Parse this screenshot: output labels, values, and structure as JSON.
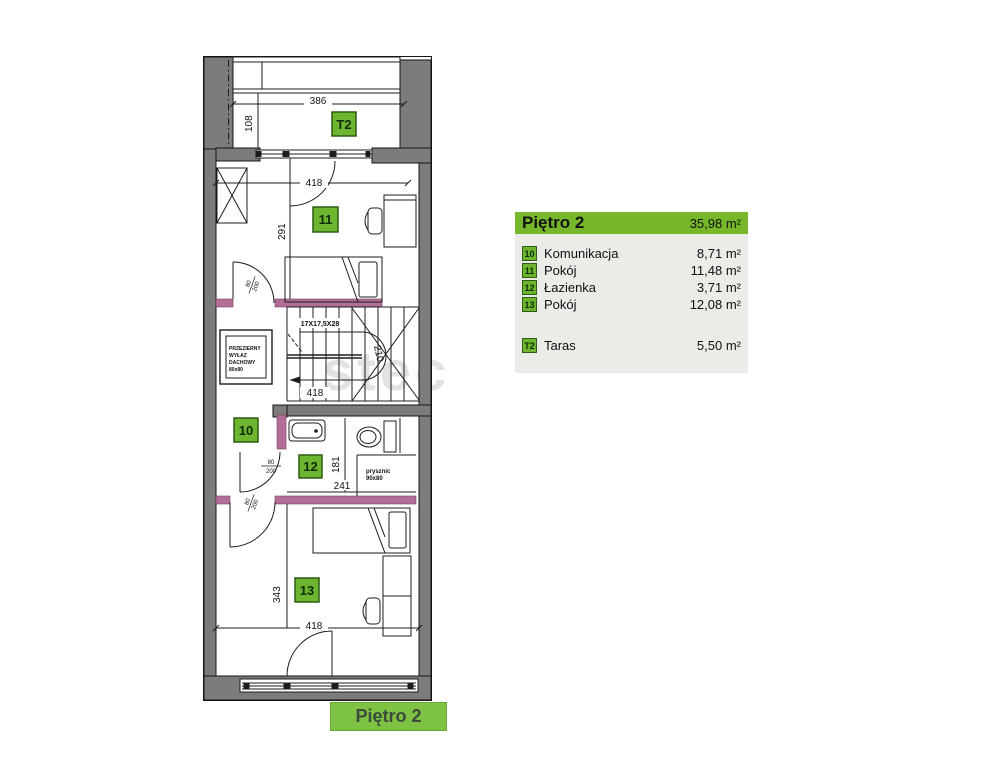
{
  "watermark": "stec",
  "legend": {
    "title": "Piętro 2",
    "total_area": "35,98 m²",
    "rows": [
      {
        "badge": "10",
        "name": "Komunikacja",
        "area": "8,71 m²"
      },
      {
        "badge": "11",
        "name": "Pokój",
        "area": "11,48 m²"
      },
      {
        "badge": "12",
        "name": "Łazienka",
        "area": "3,71 m²"
      },
      {
        "badge": "13",
        "name": "Pokój",
        "area": "12,08 m²"
      }
    ],
    "terrace_row": {
      "badge": "T2",
      "name": "Taras",
      "area": "5,50 m²"
    }
  },
  "footer": {
    "label": "Piętro 2"
  },
  "plan": {
    "room_badges": {
      "terrace": "T2",
      "room10": "10",
      "room11": "11",
      "room12": "12",
      "room13": "13"
    },
    "dimensions": {
      "terrace_width": "386",
      "terrace_depth": "108",
      "room11_width": "418",
      "room11_depth": "291",
      "stairs_spec": "17X17,5X28",
      "stairs_run": "418",
      "stairs_height": "210",
      "bath_depth": "181",
      "bath_width": "241",
      "room13_depth": "343",
      "room13_width": "418",
      "door_width": "80",
      "door_height": "200"
    },
    "labels": {
      "skylight_line1": "PRZEZIERNY",
      "skylight_line2": "WYŁAZ",
      "skylight_line3": "DACHOWY",
      "skylight_line4": "80x80",
      "shower_line1": "prysznic",
      "shower_line2": "90x80"
    }
  },
  "colors": {
    "wall": "#7c7c7c",
    "partition": "#b26e96",
    "accent_green": "#76b82a",
    "badge_green": "#6db52f",
    "caption_green": "#7dc242",
    "legend_bg": "#ebece8"
  }
}
